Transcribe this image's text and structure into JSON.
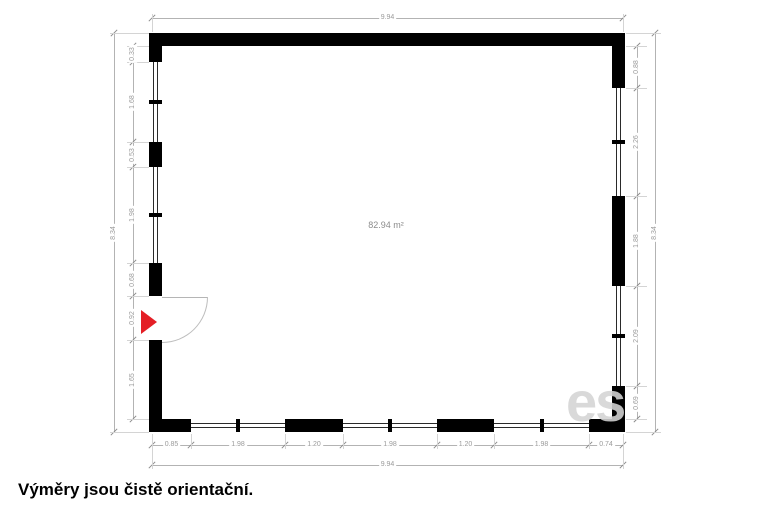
{
  "plan": {
    "area_label": "82.94 m²"
  },
  "dimensions": {
    "top_total": "9.94",
    "bottom_total": "9.94",
    "left_total": "8.34",
    "right_total": "8.34",
    "bottom_segments": [
      "0.85",
      "1.98",
      "1.20",
      "1.98",
      "1.20",
      "1.98",
      "0.74"
    ],
    "left_segments": [
      "0.33",
      "1.68",
      "0.53",
      "1.98",
      "0.68",
      "0.92",
      "1.65"
    ],
    "right_segments": [
      "0.88",
      "2.26",
      "1.88",
      "2.09",
      "0.69"
    ]
  },
  "caption": "Výměry jsou čistě orientační.",
  "watermark": "es",
  "icons": {
    "entrance_marker": "red-arrow-right-icon"
  },
  "colors": {
    "wall": "#000000",
    "dimension_text": "#9b9b9b",
    "area_text": "#8c8c8c",
    "entrance_arrow": "#e41e25",
    "background": "#ffffff"
  }
}
